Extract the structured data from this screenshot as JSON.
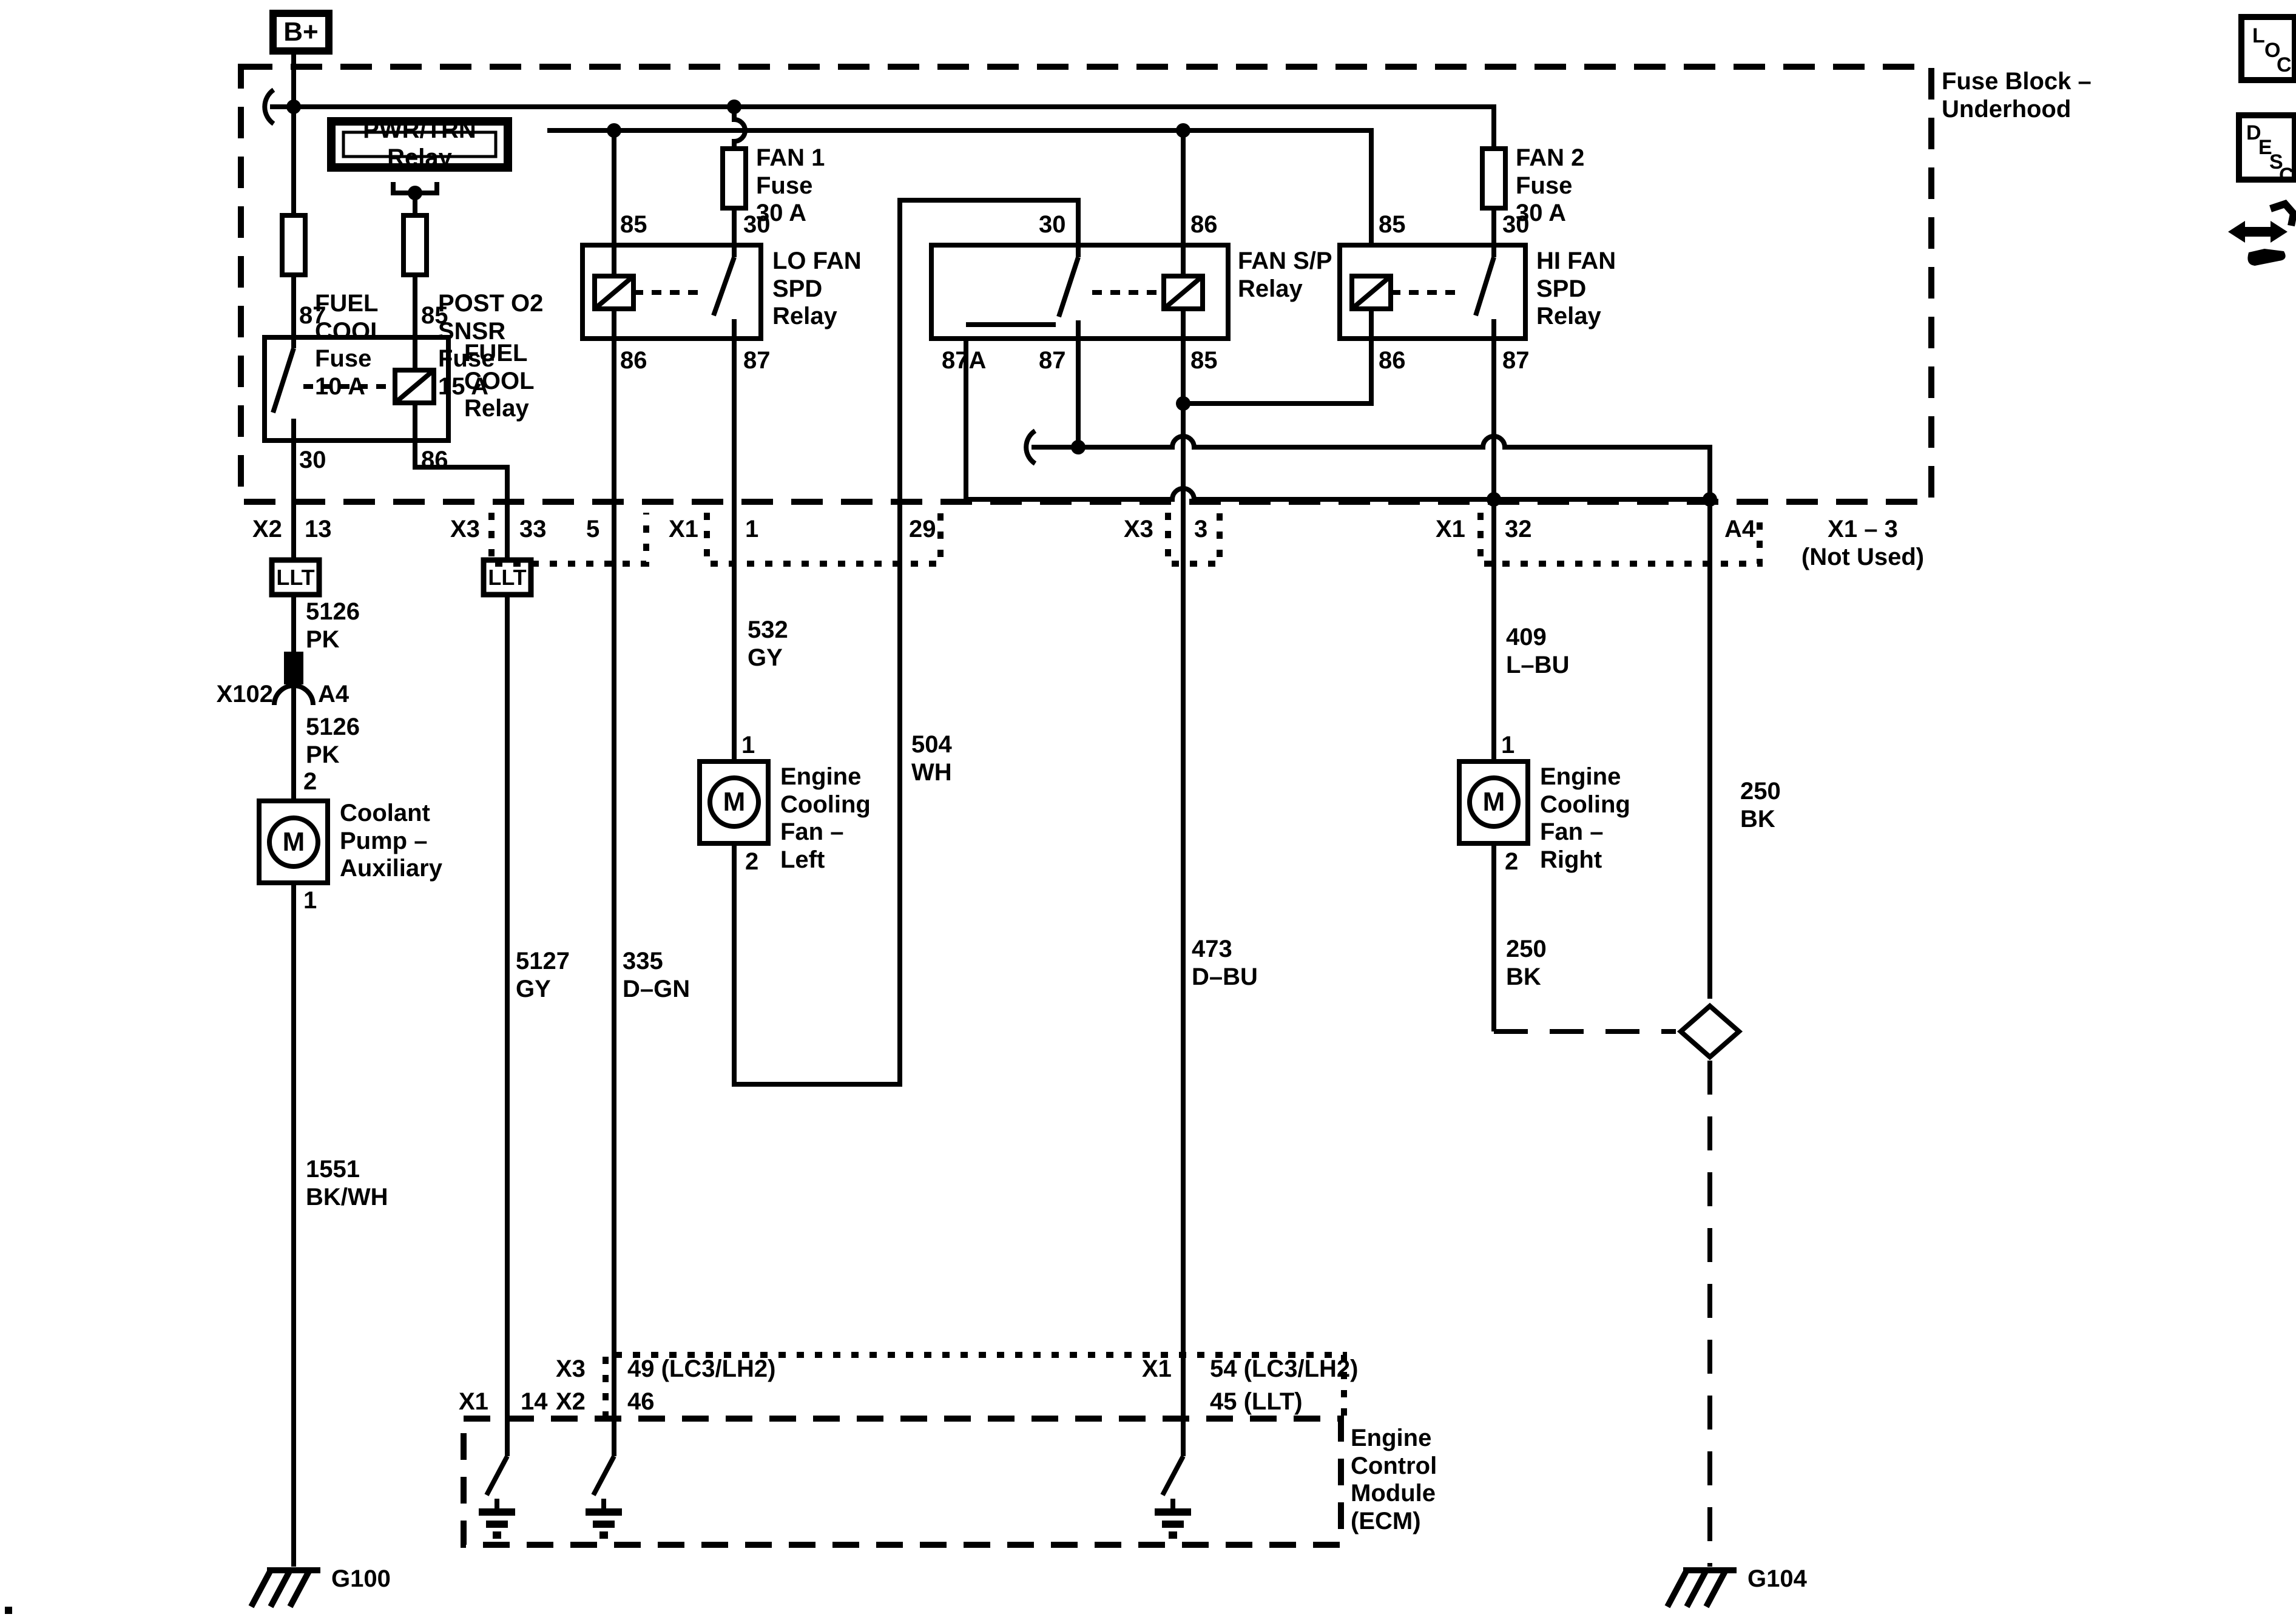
{
  "page": {
    "background": "#ffffff",
    "line_color": "#000000"
  },
  "power": {
    "b_plus": "B+",
    "pwr_trn_relay": "PWR/TRN Relay"
  },
  "fuse_block": {
    "title": "Fuse Block –\nUnderhood",
    "fuses": {
      "fuel_cool": "FUEL\nCOOL\nFuse\n10 A",
      "post_o2": "POST O2\nSNSR\nFuse\n15 A",
      "fan1": "FAN 1\nFuse\n30 A",
      "fan2": "FAN 2\nFuse\n30 A"
    },
    "relays": {
      "fuel_cool": "FUEL\nCOOL\nRelay",
      "lo_fan": "LO FAN\nSPD\nRelay",
      "fan_sp": "FAN S/P\nRelay",
      "hi_fan": "HI FAN\nSPD\nRelay"
    },
    "pins": {
      "fc_87": "87",
      "fc_85": "85",
      "fc_30": "30",
      "fc_86": "86",
      "lo_85": "85",
      "lo_30": "30",
      "lo_86": "86",
      "lo_87": "87",
      "sp_30": "30",
      "sp_86": "86",
      "sp_87a": "87A",
      "sp_87": "87",
      "sp_85": "85",
      "hi_85": "85",
      "hi_30": "30",
      "hi_86": "86",
      "hi_87": "87"
    }
  },
  "connectors": {
    "x2": "X2",
    "p13": "13",
    "x3_left": "X3",
    "p33": "33",
    "p5": "5",
    "x1_left": "X1",
    "p1": "1",
    "p29": "29",
    "x3_mid": "X3",
    "p3": "3",
    "x1_right": "X1",
    "p32": "32",
    "a4": "A4",
    "not_used": "X1 – 3\n(Not Used)",
    "llt1": "LLT",
    "llt2": "LLT",
    "x102": "X102",
    "x102_a4": "A4"
  },
  "wires": {
    "w5126_upper": "5126\nPK",
    "w5126_lower": "5126\nPK",
    "w1551": "1551\nBK/WH",
    "w5127": "5127\nGY",
    "w335": "335\nD–GN",
    "w532": "532\nGY",
    "w504": "504\nWH",
    "w473": "473\nD–BU",
    "w409": "409\nL–BU",
    "w250_fan": "250\nBK",
    "w250_right": "250\nBK"
  },
  "components": {
    "coolant_pump": "Coolant\nPump –\nAuxiliary",
    "pump_pin2": "2",
    "pump_pin1": "1",
    "pump_motor": "M",
    "left_fan": "Engine\nCooling\nFan –\nLeft",
    "lfan_pin1": "1",
    "lfan_pin2": "2",
    "lfan_motor": "M",
    "right_fan": "Engine\nCooling\nFan –\nRight",
    "rfan_pin1": "1",
    "rfan_pin2": "2",
    "rfan_motor": "M"
  },
  "ecm": {
    "title": "Engine\nControl\nModule\n(ECM)",
    "x1_left": "X1",
    "p14": "14",
    "x3": "X3",
    "p49": "49 (LC3/LH2)",
    "x2": "X2",
    "p46": "46",
    "x1_right": "X1",
    "p54": "54 (LC3/LH2)",
    "p45": "45 (LLT)"
  },
  "grounds": {
    "g100": "G100",
    "g104": "G104"
  },
  "icons": {
    "loc_l": "L",
    "loc_o": "O",
    "loc_c": "C",
    "desc_d": "D",
    "desc_e": "E",
    "desc_s": "S",
    "desc_c": "C"
  }
}
